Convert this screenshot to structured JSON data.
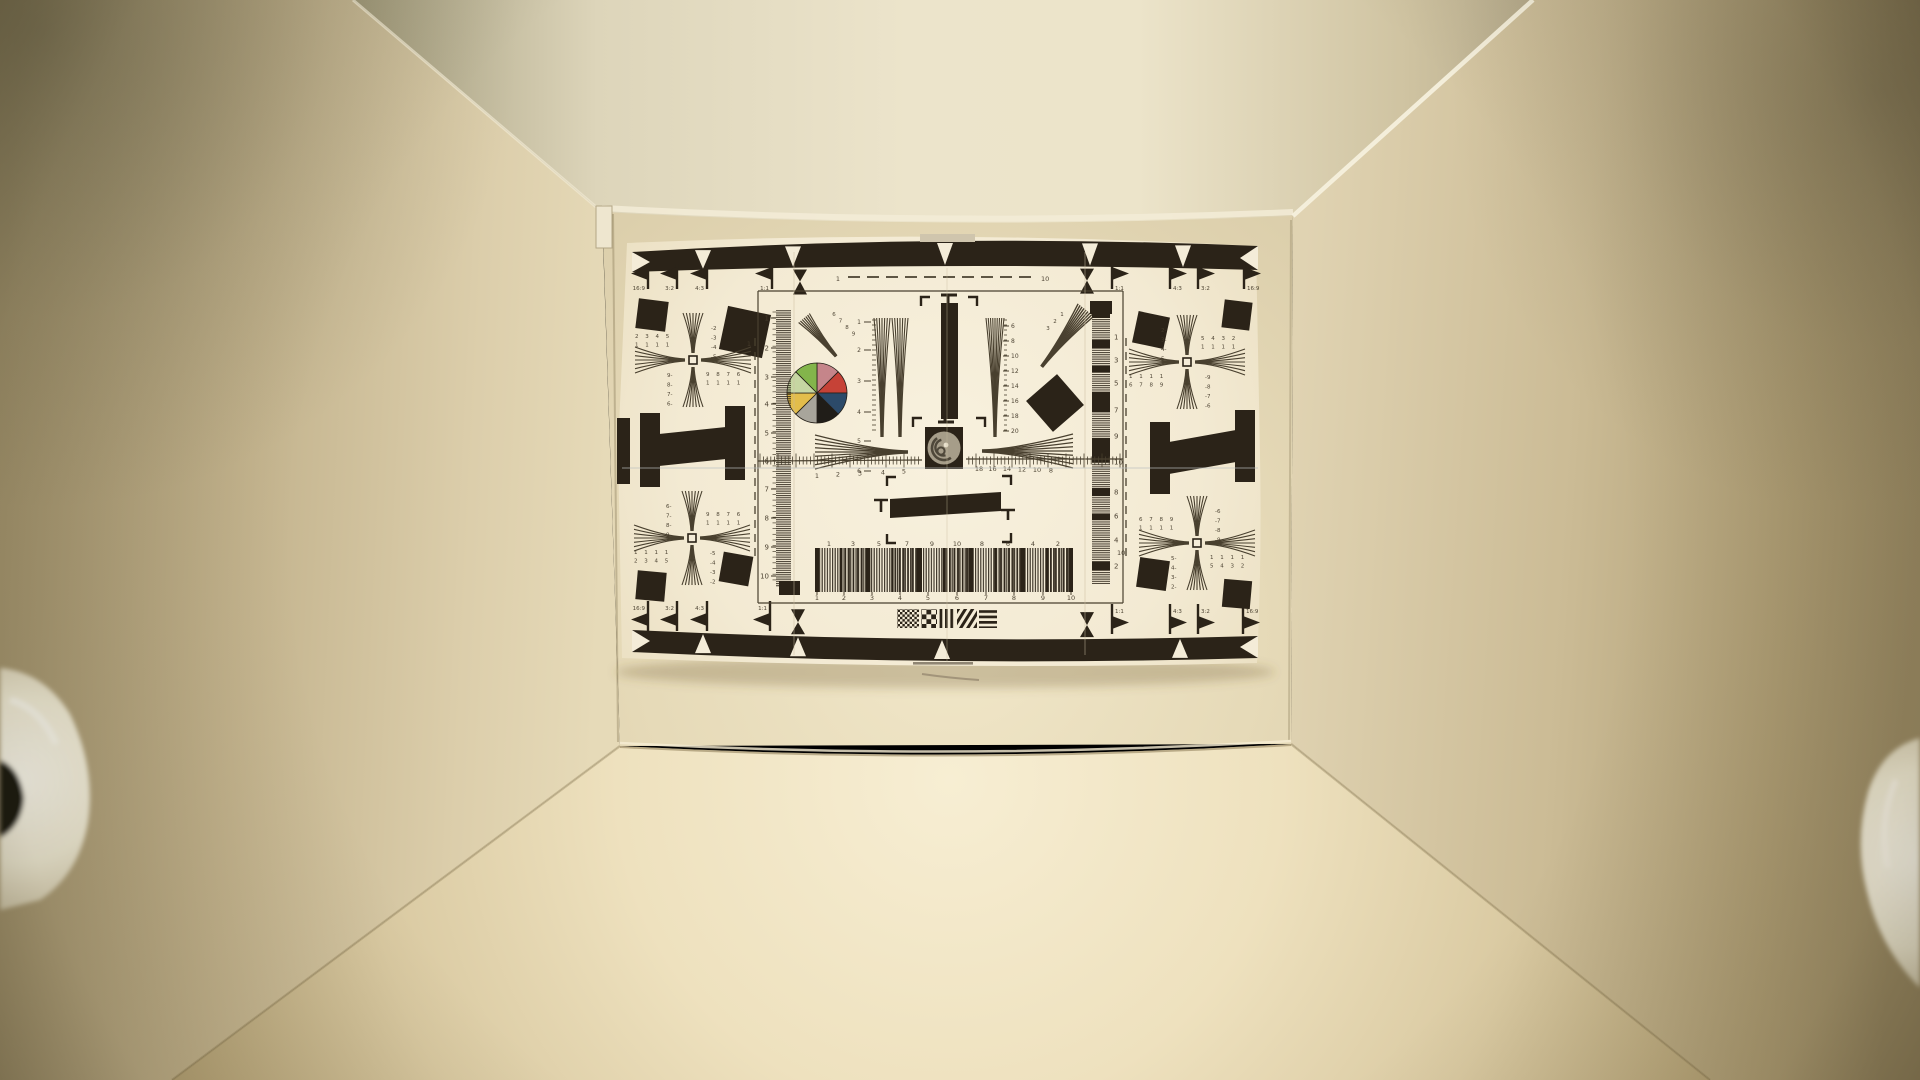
{
  "scene": {
    "type": "photograph",
    "subject": "ISO-style camera resolution test chart mounted on the back wall of a warm tungsten-lit light box",
    "colors": {
      "ink": "#2b2318",
      "ink_soft": "#49402f",
      "paper": "#f5ecd6",
      "paper_edge": "#e8dcbd",
      "ceiling_bright": "#efe8d0",
      "wall_dark": "#a1906a",
      "wall_mid": "#d5c7a4",
      "back_wall": "#e7dbba",
      "floor_bright": "#f7eed2",
      "floor_dark": "#9c8a5e",
      "lamp_white": "#f7f3e3",
      "seam": "#c9bc9e"
    }
  },
  "chart": {
    "aspect_labels": [
      "16:9",
      "3:2",
      "4:3",
      "1:1"
    ],
    "top_scale_labels": {
      "left": "1",
      "right": "10"
    },
    "side_scale_labels": {
      "left": "1",
      "right": "10"
    },
    "left_ruler_numbers": [
      "1",
      "2",
      "3",
      "4",
      "5",
      "6",
      "7",
      "8",
      "9",
      "10"
    ],
    "right_ruler_numbers": [
      "1",
      "3",
      "5",
      "7",
      "9",
      "10",
      "8",
      "6",
      "4",
      "2"
    ],
    "center_ruler_left": [
      "1",
      "2",
      "3",
      "4",
      "5"
    ],
    "center_ruler_right": [
      "18",
      "16",
      "14",
      "12",
      "10",
      "8"
    ],
    "twin_fan_scale": [
      "1",
      "2",
      "3",
      "4",
      "5",
      "6"
    ],
    "right_fan_scale": [
      "6",
      "8",
      "10",
      "12",
      "14",
      "16",
      "18",
      "20"
    ],
    "diag_fan_digits_left": [
      "6",
      "7",
      "8",
      "9"
    ],
    "diag_fan_digits_right": [
      "1",
      "2",
      "3"
    ],
    "grating_numbers_top": [
      "1",
      "3",
      "5",
      "7",
      "9",
      "10",
      "8",
      "6",
      "4",
      "2"
    ],
    "grating_numbers_bottom": [
      "1",
      "2",
      "3",
      "4",
      "5",
      "6",
      "7",
      "8",
      "9",
      "10"
    ],
    "crosses": [
      {
        "id": "tl",
        "x": 693,
        "y": 360,
        "nw_rows": [
          "2 3 4 5",
          "1 1 1 1"
        ],
        "ne_col": [
          "-2",
          "-3",
          "-4",
          "-5"
        ],
        "sw_col": [
          "9-",
          "8-",
          "7-",
          "6-"
        ],
        "se_rows": [
          "9 8 7 6",
          "1 1 1 1"
        ]
      },
      {
        "id": "bl",
        "x": 692,
        "y": 538,
        "nw_col": [
          "6-",
          "7-",
          "8-",
          "9-"
        ],
        "ne_rows": [
          "9 8 7 6",
          "1 1 1 1"
        ],
        "sw_rows": [
          "1 1 1 1",
          "2 3 4 5"
        ],
        "se_col": [
          "-5",
          "-4",
          "-3",
          "-2"
        ]
      },
      {
        "id": "tr",
        "x": 1187,
        "y": 362,
        "nw_col": [
          "2-",
          "3-",
          "4-",
          "5-"
        ],
        "ne_rows": [
          "5 4 3 2",
          "1 1 1 1"
        ],
        "sw_rows": [
          "1 1 1 1",
          "6 7 8 9"
        ],
        "se_col": [
          "-9",
          "-8",
          "-7",
          "-6"
        ]
      },
      {
        "id": "br",
        "x": 1197,
        "y": 543,
        "nw_rows": [
          "6 7 8 9",
          "1 1 1 1"
        ],
        "ne_col": [
          "-6",
          "-7",
          "-8",
          "-9"
        ],
        "sw_col": [
          "5-",
          "4-",
          "3-",
          "2-"
        ],
        "se_rows": [
          "1 1 1 1",
          "5 4 3 2"
        ]
      }
    ],
    "color_wheel": {
      "cx": 817,
      "cy": 393,
      "r": 30,
      "segments": [
        {
          "name": "rose",
          "hex": "#c5858a"
        },
        {
          "name": "red",
          "hex": "#c64237"
        },
        {
          "name": "navy",
          "hex": "#2c4a69"
        },
        {
          "name": "black",
          "hex": "#201d18"
        },
        {
          "name": "gray",
          "hex": "#a8a59b"
        },
        {
          "name": "yellow",
          "hex": "#e3bd4b"
        },
        {
          "name": "pale-green",
          "hex": "#c6d6a2"
        },
        {
          "name": "green",
          "hex": "#83b54b"
        }
      ]
    },
    "band_marker_positions": {
      "top": [
        703,
        793,
        945,
        1090,
        1183
      ],
      "bottom": [
        703,
        798,
        942,
        1180
      ]
    },
    "aspect_marker_sets": {
      "top_left": [
        {
          "x": 648,
          "label": "16:9"
        },
        {
          "x": 677,
          "label": "3:2"
        },
        {
          "x": 707,
          "label": "4:3"
        },
        {
          "x": 772,
          "label": "1:1"
        }
      ],
      "top_right": [
        {
          "x": 1112,
          "label": "1:1"
        },
        {
          "x": 1170,
          "label": "4:3"
        },
        {
          "x": 1198,
          "label": "3:2"
        },
        {
          "x": 1244,
          "label": "16:9"
        }
      ],
      "bottom_left": [
        {
          "x": 648,
          "label": "16:9"
        },
        {
          "x": 677,
          "label": "3:2"
        },
        {
          "x": 707,
          "label": "4:3"
        },
        {
          "x": 770,
          "label": "1:1"
        }
      ],
      "bottom_right": [
        {
          "x": 1112,
          "label": "1:1"
        },
        {
          "x": 1170,
          "label": "4:3"
        },
        {
          "x": 1198,
          "label": "3:2"
        },
        {
          "x": 1243,
          "label": "16:9"
        }
      ]
    }
  }
}
